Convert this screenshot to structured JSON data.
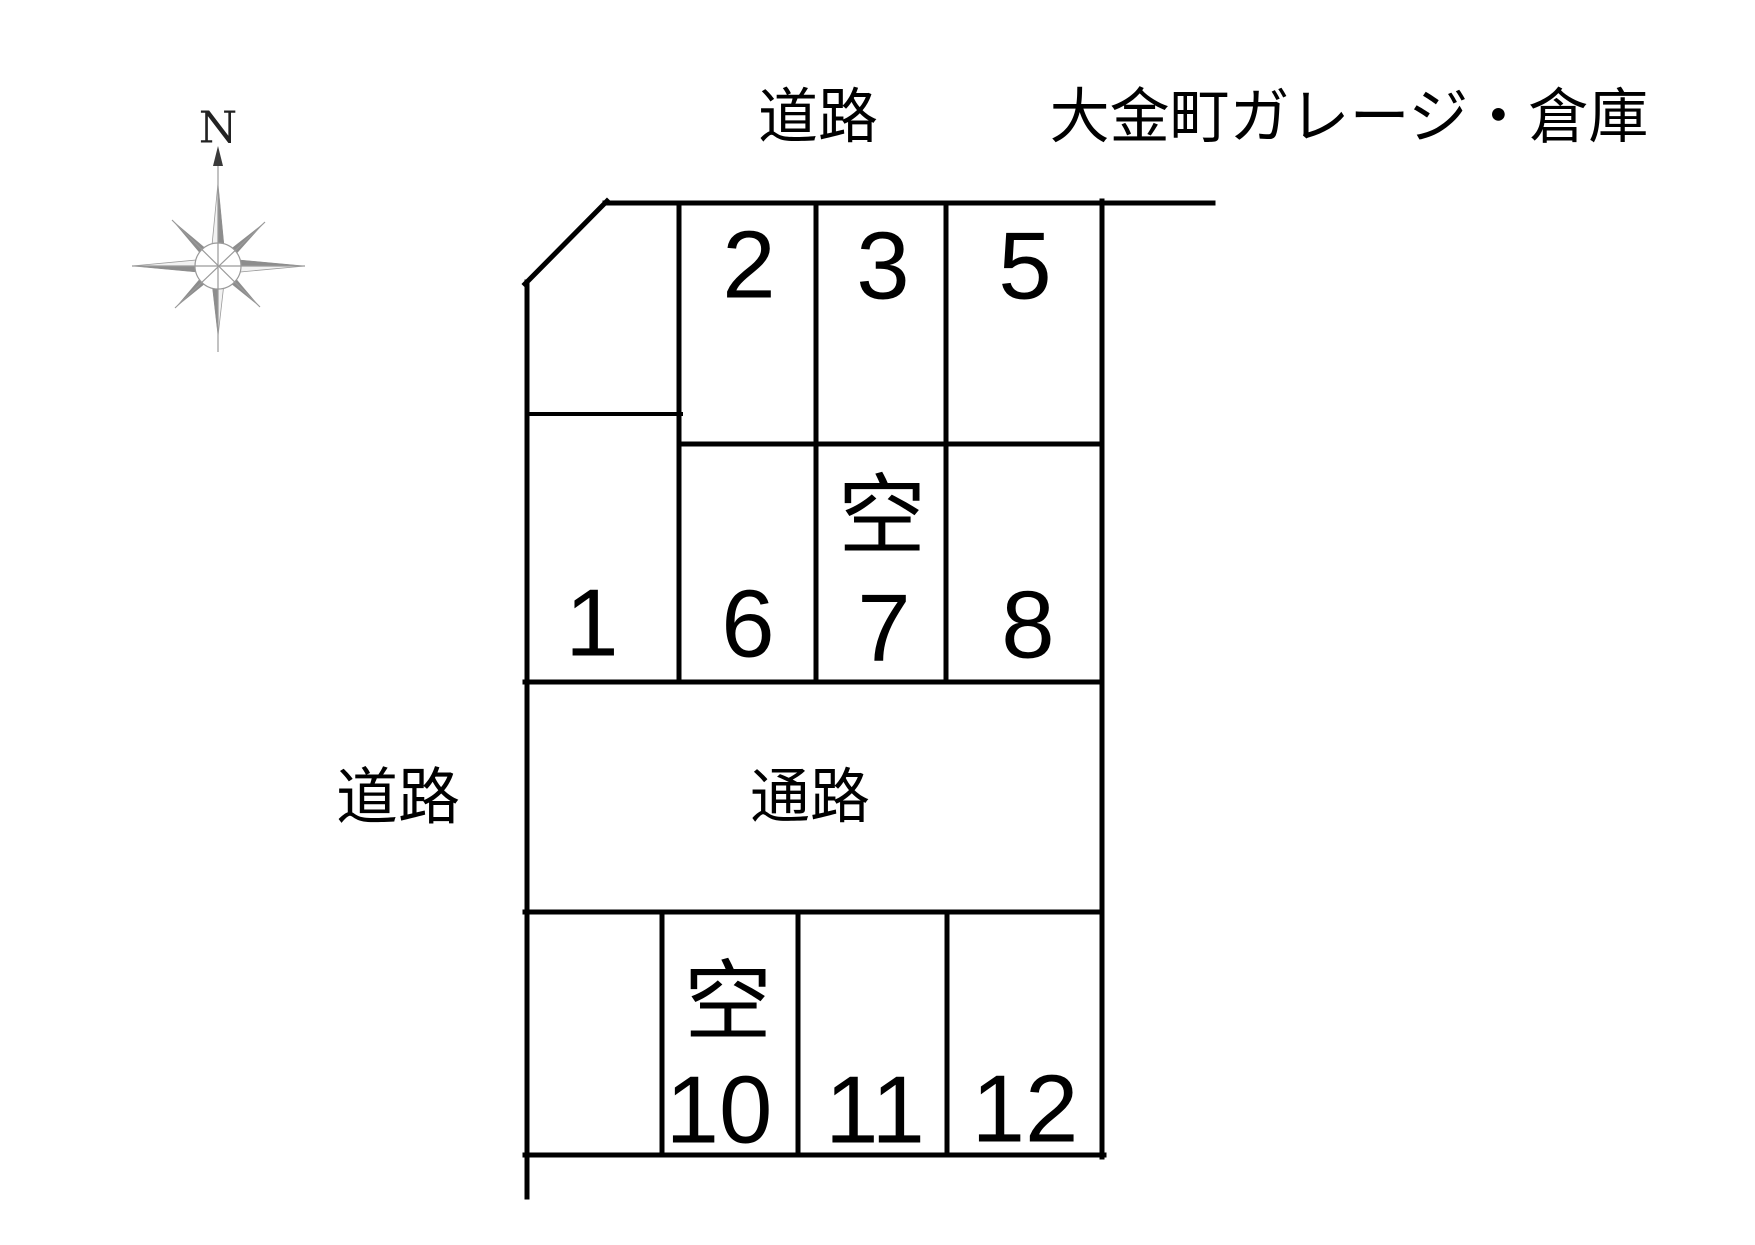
{
  "header": {
    "road_label": "道路",
    "title": "大金町ガレージ・倉庫"
  },
  "left_road_label": "道路",
  "aisle_label": "通路",
  "compass": {
    "north_label": "N"
  },
  "labels": {
    "vacant": "空"
  },
  "colors": {
    "line": "#000000",
    "vacant_red": "#e60012",
    "compass_dark": "#8d8d8d",
    "compass_light": "#f2f2f2"
  },
  "spaces": [
    {
      "number": "2",
      "vacant": false
    },
    {
      "number": "3",
      "vacant": false
    },
    {
      "number": "5",
      "vacant": false
    },
    {
      "number": "1",
      "vacant": false
    },
    {
      "number": "6",
      "vacant": false
    },
    {
      "number": "7",
      "vacant": true
    },
    {
      "number": "8",
      "vacant": false
    },
    {
      "number": "10",
      "vacant": true
    },
    {
      "number": "11",
      "vacant": false
    },
    {
      "number": "12",
      "vacant": false
    }
  ]
}
